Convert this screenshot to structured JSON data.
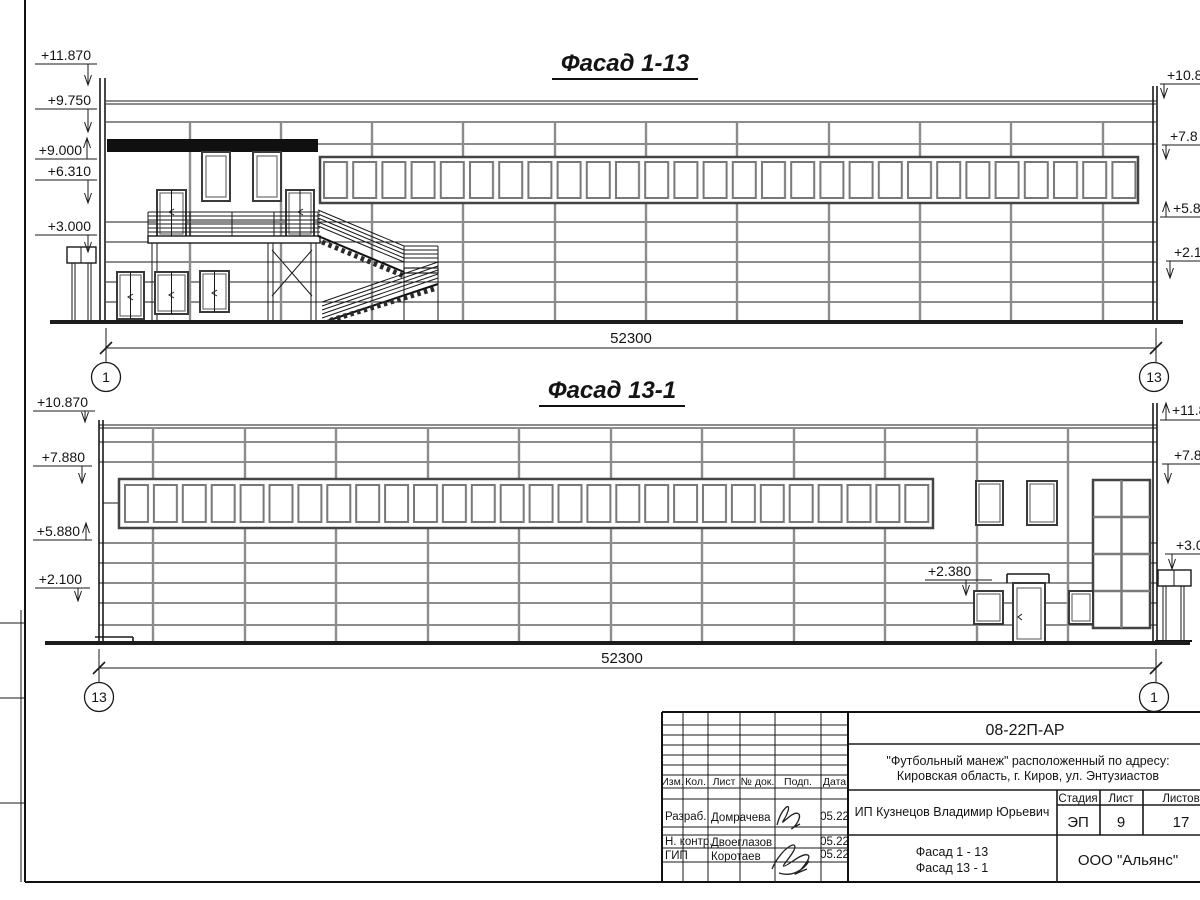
{
  "facade_top": {
    "title": "Фасад 1-13",
    "marks_left": [
      "+11.870",
      "+9.750",
      "+9.000",
      "+6.310",
      "+3.000"
    ],
    "marks_right": [
      "+10.8",
      "+7.8",
      "+5.8",
      "+2.1"
    ],
    "dimension": "52300",
    "axis_left": "1",
    "axis_right": "13"
  },
  "facade_bottom": {
    "title": "Фасад 13-1",
    "marks_left": [
      "+10.870",
      "+7.880",
      "+5.880",
      "+2.100"
    ],
    "marks_right": [
      "+11.8",
      "+7.8",
      "+3.0"
    ],
    "door_mark": "+2.380",
    "dimension": "52300",
    "axis_left": "13",
    "axis_right": "1"
  },
  "title_block": {
    "doc_code": "08-22П-АР",
    "object_line1": "\"Футбольный манеж\" расположенный по адресу:",
    "object_line2": "Кировская область, г. Киров, ул. Энтузиастов",
    "cols": {
      "izm": "Изм.",
      "kol": "Кол.",
      "list": "Лист",
      "ndok": "№ док.",
      "podp": "Подп.",
      "date": "Дата"
    },
    "sign_rows": [
      {
        "role": "Разраб.",
        "name": "Домрачева",
        "date": "05.22"
      },
      {
        "role": "Н. контр.",
        "name": "Двоеглазов",
        "date": "05.22"
      },
      {
        "role": "ГИП",
        "name": "Коротаев",
        "date": "05.22"
      }
    ],
    "client": "ИП Кузнецов Владимир Юрьевич",
    "stage_label": "Стадия",
    "sheet_label": "Лист",
    "sheets_label": "Листов",
    "stage": "ЭП",
    "sheet_number": "9",
    "sheets_total": "17",
    "drawing_title_1": "Фасад 1 - 13",
    "drawing_title_2": "Фасад 13 - 1",
    "company": "ООО \"Альянс\""
  }
}
